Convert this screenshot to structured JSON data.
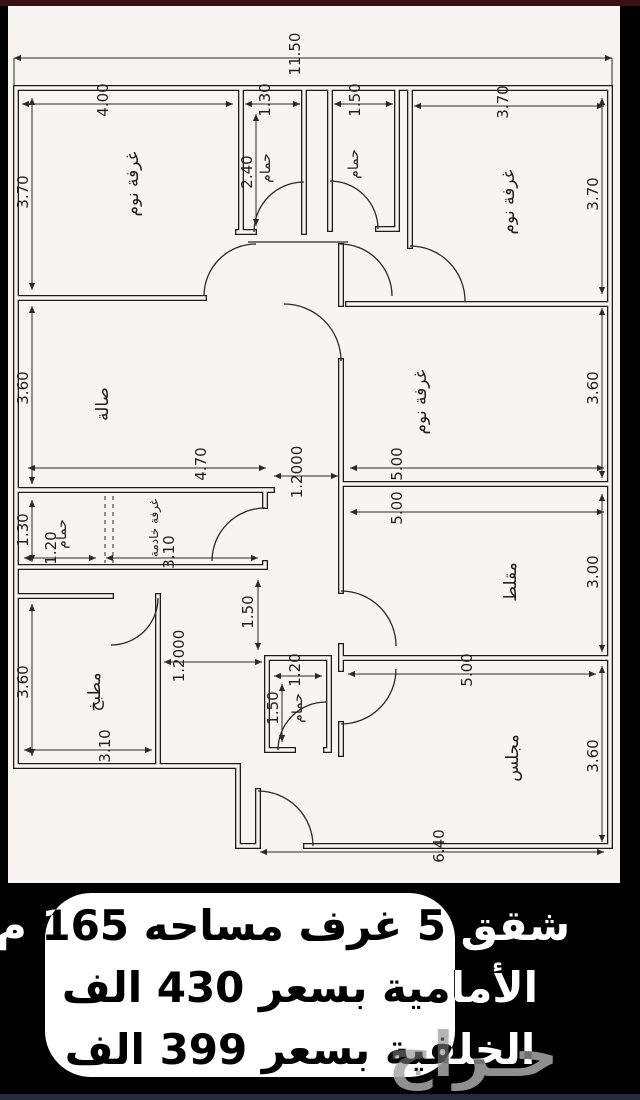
{
  "plan": {
    "overall": "11.50",
    "dims": {
      "tl_w": "4.00",
      "tl_h": "3.70",
      "b1_w": "1.30",
      "b1_d": "2.40",
      "b2_w": "1.50",
      "tr_w": "3.70",
      "tr_h": "3.70",
      "hall_h": "3.60",
      "hall_w": "4.70",
      "corr1": "1.2000",
      "br_h": "3.60",
      "br_w": "5.00",
      "mb_h": "1.30",
      "mb_w": "1.20",
      "maid_w": "3.10",
      "mq_w": "5.00",
      "mq_h": "3.00",
      "kit_h": "3.60",
      "kit_w": "3.10",
      "corr2": "1.2000",
      "corr_h": "1.50",
      "sb_w": "1.20",
      "sb_h": "1.50",
      "mj_w": "5.00",
      "mj_h": "3.60",
      "mj_b": "6.40"
    },
    "rooms": {
      "tl": "غرفة نوم",
      "b1": "حمام",
      "b2": "حمام",
      "tr": "غرفة نوم",
      "hall": "صالة",
      "br": "غرفة نوم",
      "maid": "غرفة خادمة",
      "mbath": "حمام",
      "kitchen": "مطبخ",
      "sbath": "حمام",
      "muqallat": "مقلط",
      "majlis": "مجلس"
    }
  },
  "banner": {
    "line1": "شقق 5 غرف مساحه 165 م",
    "line2": "الأمامية بسعر 430 الف",
    "line3": "الخلفية بسعر 399 الف"
  },
  "watermark": "حـراج"
}
